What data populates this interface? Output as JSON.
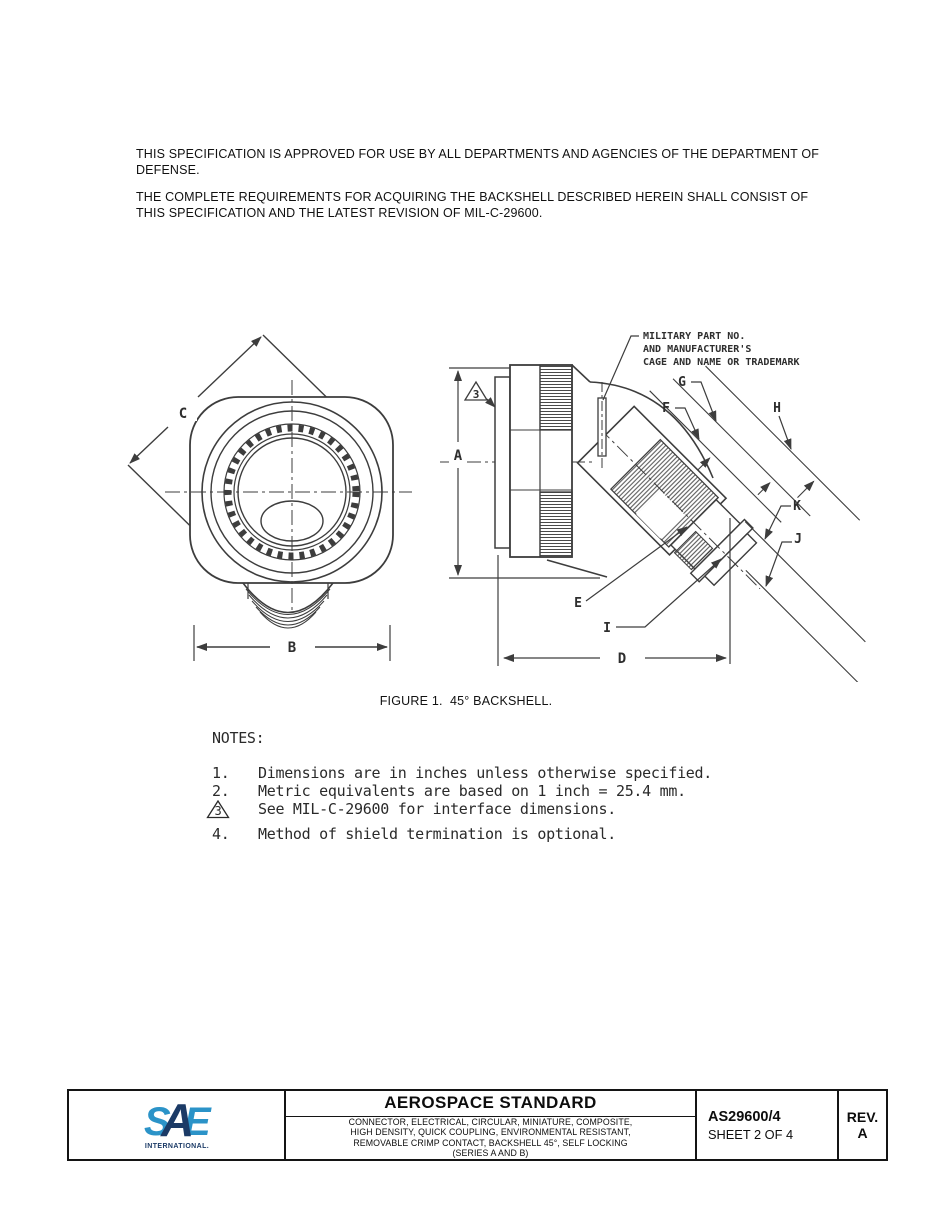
{
  "intro": {
    "p1": "THIS SPECIFICATION IS APPROVED FOR USE BY ALL DEPARTMENTS AND AGENCIES OF THE DEPARTMENT OF DEFENSE.",
    "p2": "THE COMPLETE REQUIREMENTS FOR ACQUIRING THE BACKSHELL DESCRIBED HEREIN SHALL CONSIST OF THIS SPECIFICATION AND THE LATEST REVISION OF MIL-C-29600."
  },
  "figure": {
    "caption": "FIGURE 1.  45° BACKSHELL.",
    "callout": [
      "MILITARY PART NO.",
      "AND MANUFACTURER'S",
      "CAGE AND NAME OR TRADEMARK"
    ],
    "flag_note": "3",
    "labels": {
      "a": "A",
      "b": "B",
      "c": "C",
      "d": "D",
      "e": "E",
      "f": "F",
      "g": "G",
      "h": "H",
      "i": "I",
      "j": "J",
      "k": "K"
    }
  },
  "notes": {
    "heading": "NOTES:",
    "items": [
      {
        "num": "1.",
        "text": "Dimensions are in inches unless otherwise specified."
      },
      {
        "num": "2.",
        "text": "Metric equivalents are based on 1 inch = 25.4 mm."
      },
      {
        "num": "3",
        "text": "See MIL-C-29600 for interface dimensions."
      },
      {
        "num": "4.",
        "text": "Method of shield termination is optional."
      }
    ]
  },
  "titleblock": {
    "logo": {
      "s": "S",
      "a": "A",
      "e": "E",
      "sub": "INTERNATIONAL."
    },
    "heading": "AEROSPACE STANDARD",
    "desc": [
      "CONNECTOR, ELECTRICAL, CIRCULAR, MINIATURE, COMPOSITE,",
      "HIGH DENSITY, QUICK COUPLING, ENVIRONMENTAL RESISTANT,",
      "REMOVABLE CRIMP CONTACT, BACKSHELL 45°, SELF LOCKING",
      "(SERIES A AND B)"
    ],
    "doc_number": "AS29600/4",
    "sheet": "SHEET 2 OF 4",
    "rev_label": "REV.",
    "rev_value": "A"
  },
  "colors": {
    "sae_light_blue": "#2B93C8",
    "sae_dark_blue": "#1B3A66",
    "ink": "#1a1a1a",
    "draw": "#3d3d3d"
  }
}
